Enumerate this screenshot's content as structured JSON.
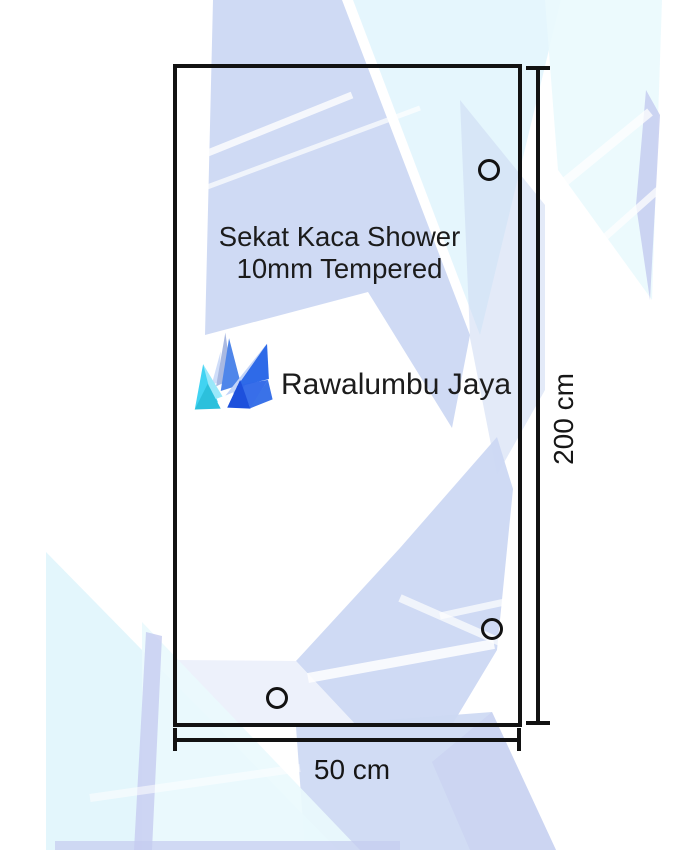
{
  "diagram": {
    "panel_label": {
      "line1": "Sekat Kaca Shower",
      "line2": "10mm Tempered"
    },
    "brand": "Rawalumbu Jaya",
    "dimensions": {
      "height": "200 cm",
      "width": "50 cm"
    },
    "mounting_holes": 3
  },
  "colors": {
    "line": "#121212",
    "text": "#1b1b1b",
    "peri": "#ccd8f3",
    "peri_pale": "#e7ecfa",
    "cyan": "#def4fc",
    "cyan_light": "#eafafd",
    "lavender": "#c5ccf0",
    "streak": "#ffffff",
    "logo": {
      "periwinkle": "#a9b9e2",
      "blue": "#4f86ea",
      "pale_blue": "#c3d4f8",
      "light_blue": "#8fb2f2",
      "royal": "#2e6ae8",
      "mid": "#3a72e8",
      "deep": "#2d66e8",
      "dark": "#1d50dc",
      "cyan": "#41d3f2",
      "cyan_light": "#9ae8fa",
      "teal": "#2cc0dc"
    }
  }
}
